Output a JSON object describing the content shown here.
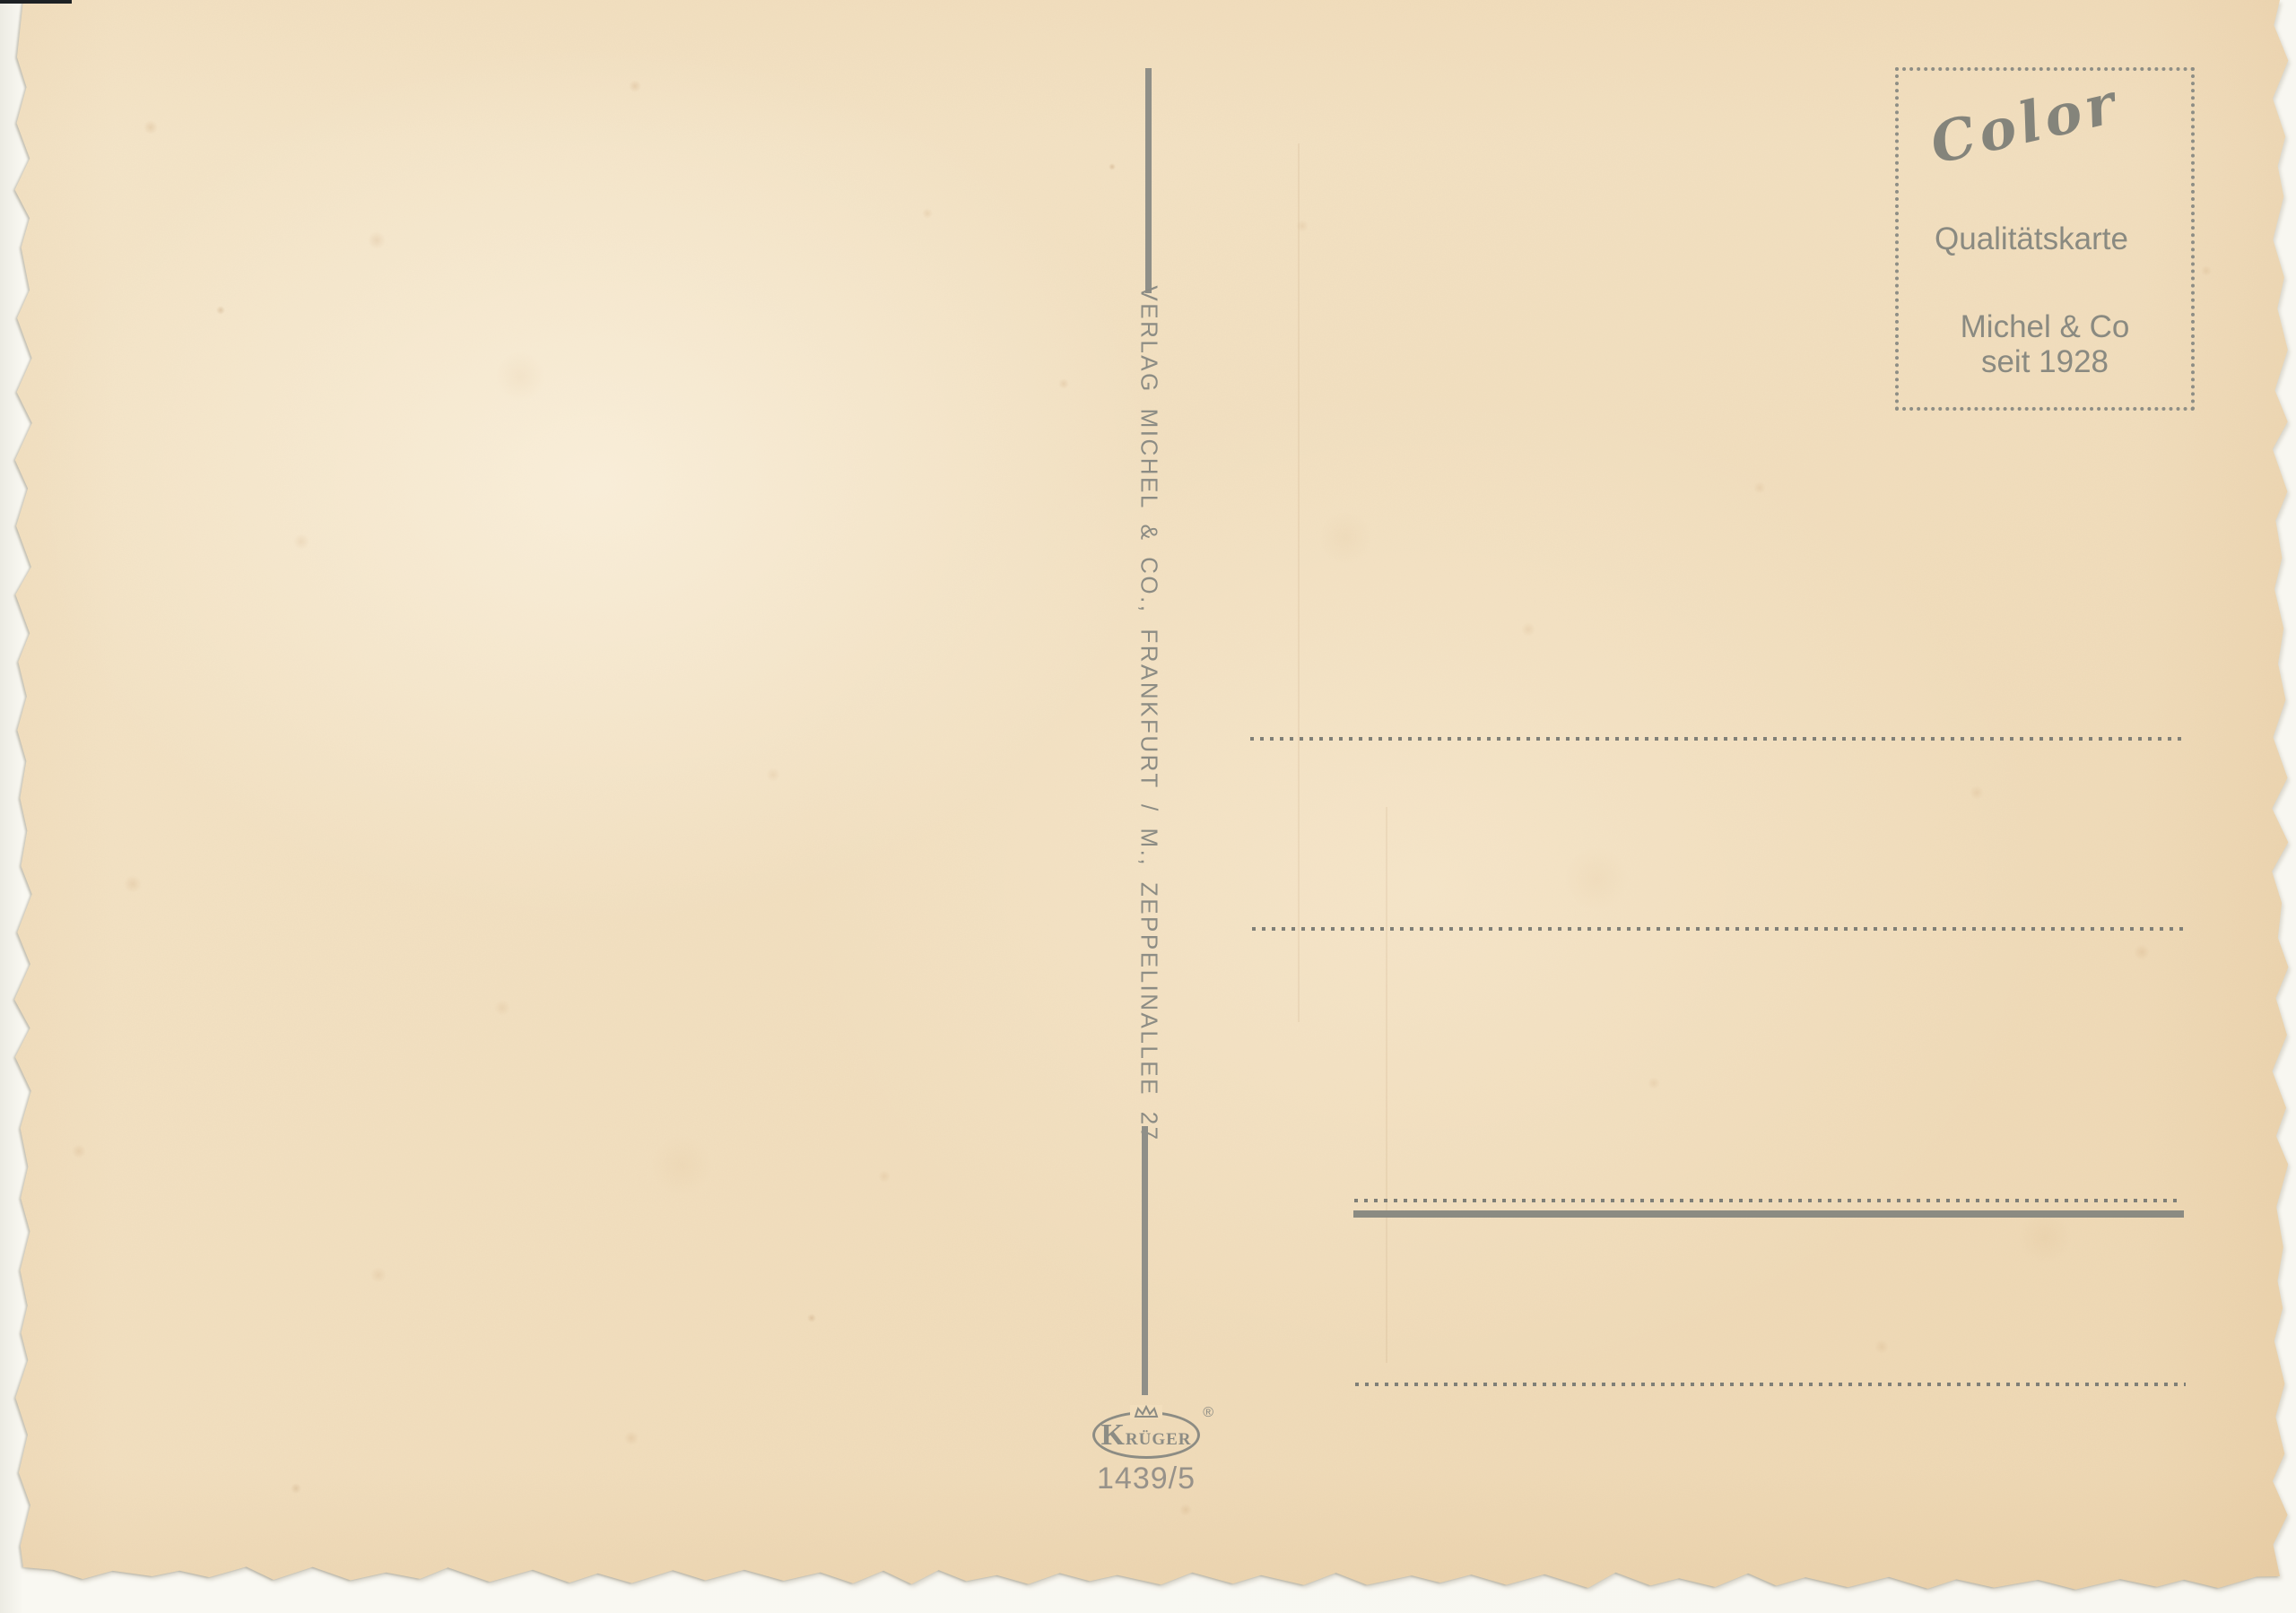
{
  "postcard": {
    "stamp_box": {
      "brand": "Color",
      "quality_label": "Qualitätskarte",
      "maker": "Michel & Co",
      "since": "seit 1928"
    },
    "publisher": {
      "imprint": "VERLAG MICHEL & CO., FRANKFURT / M., ZEPPELINALLEE 27"
    },
    "logo": {
      "name": "Krüger",
      "registered": "®",
      "number": "1439/5"
    },
    "colors": {
      "ink": "#8c8c84",
      "paper": "#f2dfbf",
      "background": "#f8f7f1"
    }
  }
}
